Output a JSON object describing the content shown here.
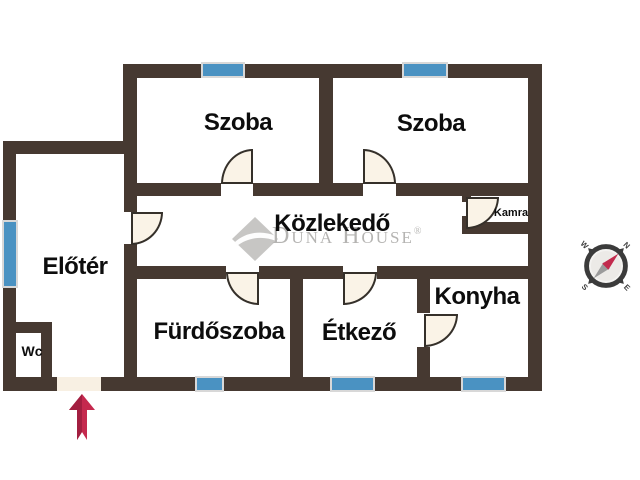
{
  "floorplan": {
    "rooms": {
      "szoba_left": {
        "label": "Szoba"
      },
      "szoba_right": {
        "label": "Szoba"
      },
      "kozlekedo": {
        "label": "Közlekedő"
      },
      "kamra": {
        "label": "Kamra"
      },
      "eloter": {
        "label": "Előtér"
      },
      "wc": {
        "label": "Wc"
      },
      "furdoszoba": {
        "label": "Fürdőszoba"
      },
      "etkezo": {
        "label": "Étkező"
      },
      "konyha": {
        "label": "Konyha"
      }
    },
    "watermark": {
      "brand": "Duna House",
      "registered": "®"
    },
    "compass": {
      "north": "N",
      "south": "S",
      "east": "E",
      "west": "W"
    },
    "colors": {
      "wall": "#463931",
      "window": "#4a92c2",
      "window_frame": "#d8d8d8",
      "door_fill": "#faf3e7",
      "door_outline": "#35302a",
      "entry_door_fill": "#f8f0e3",
      "entrance_arrow": "#c5294e",
      "watermark_gray": "#b5b4b2",
      "label_text": "#0d0d0d"
    }
  }
}
